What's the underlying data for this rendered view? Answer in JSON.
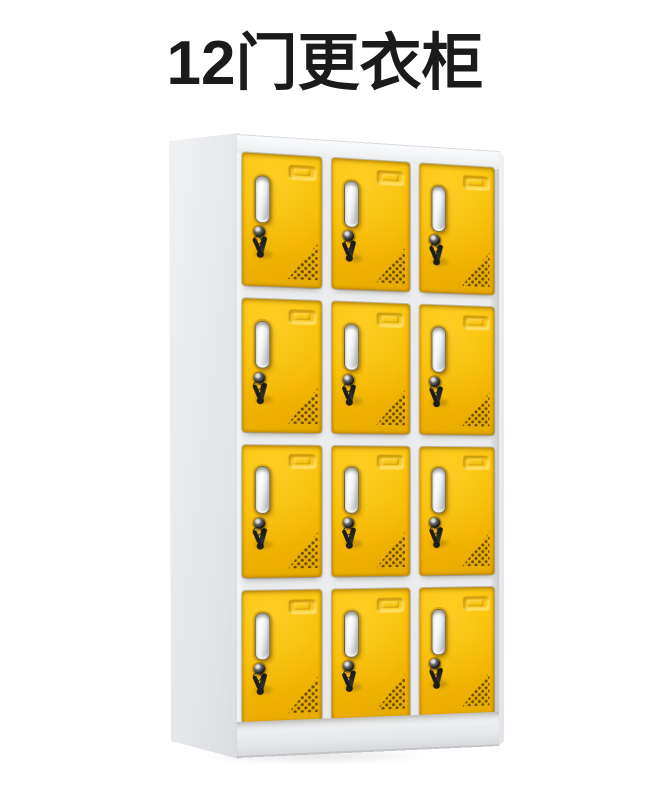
{
  "title": {
    "text": "12门更衣柜"
  },
  "product": {
    "name": "12门更衣柜",
    "door_count": 12,
    "rows": 4,
    "columns": 3,
    "colors": {
      "door_yellow": "#F7BC00",
      "door_shadow_yellow": "#D89E00",
      "frame_white": "#EDEFF1",
      "side_panel_grey": "#E3E5E8",
      "handle_silver": "#E9EBED",
      "lock_black": "#1A1A1A",
      "vent_dot_brown": "#5F4400",
      "title_text": "#1B1B1B",
      "background": "#FFFFFF"
    }
  }
}
